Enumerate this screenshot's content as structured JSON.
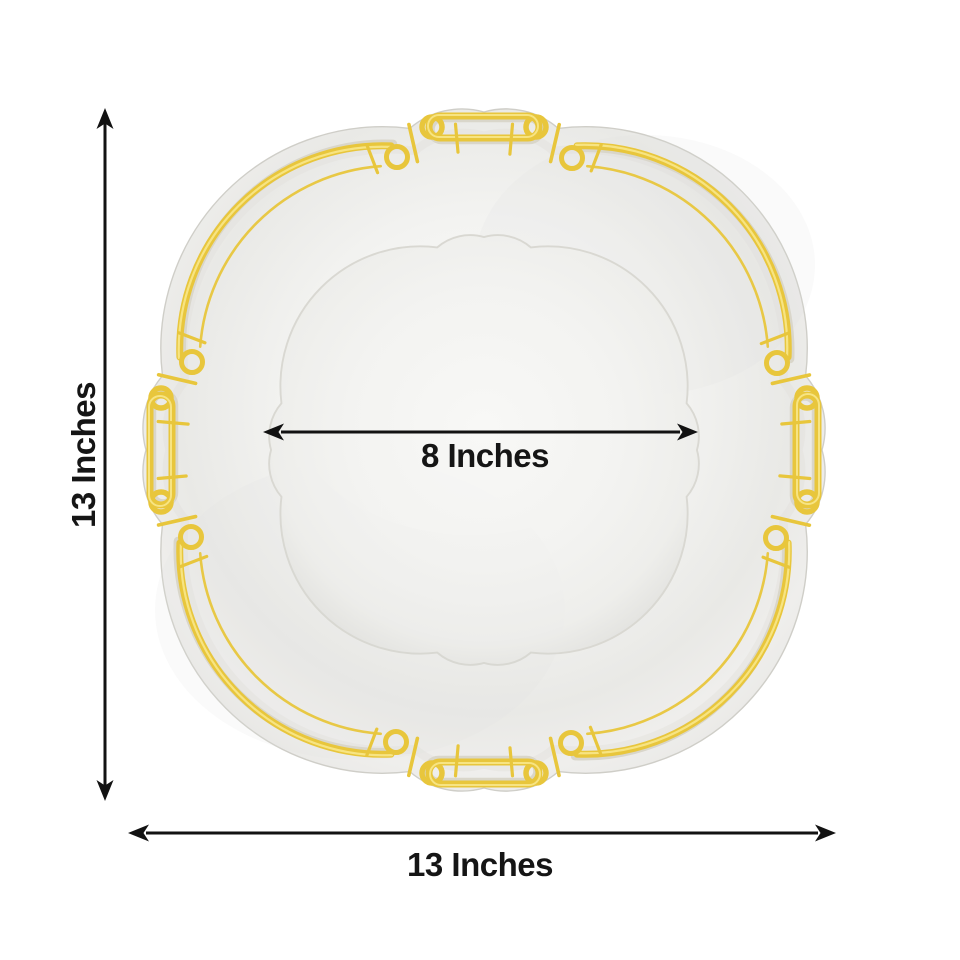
{
  "dimensions": {
    "height_label": "13 Inches",
    "width_label": "13 Inches",
    "inner_diameter_label": "8 Inches"
  },
  "icons": {
    "height_arrow": "double-headed-vertical-arrow",
    "width_arrow": "double-headed-horizontal-arrow",
    "inner_diameter_arrow": "double-headed-horizontal-arrow"
  },
  "colors": {
    "gold": "#e8c63c",
    "gold_light": "#f9e98e",
    "gold_dark": "#bd941d",
    "plate_body": "#efefed",
    "plate_center": "#f8f8f6",
    "dimension_line": "#121212",
    "label_text": "#151515",
    "background": "#ffffff"
  }
}
